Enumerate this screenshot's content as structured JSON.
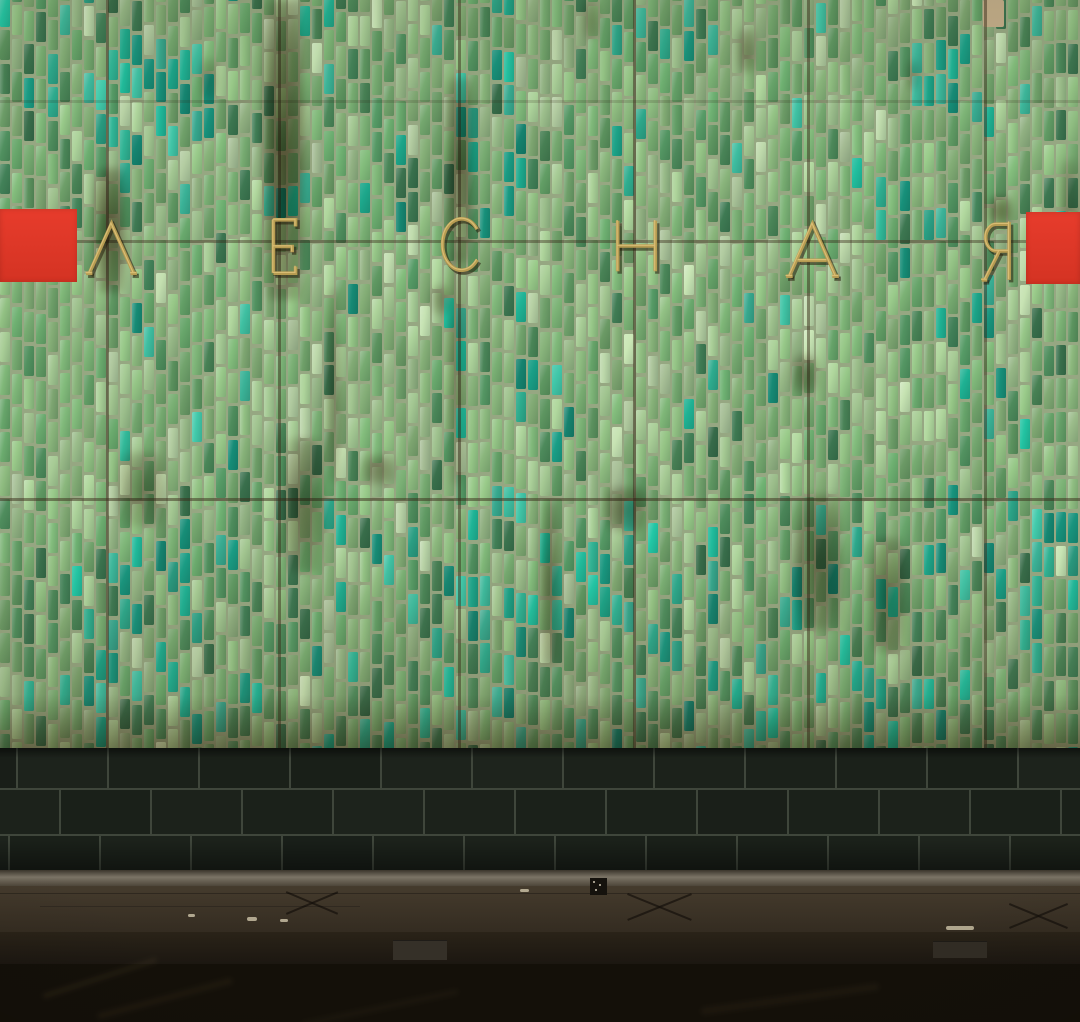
{
  "station_sign": {
    "text": "ЛЕСНАЯ",
    "letter_color": "#b79c52",
    "letter_highlight": "#d9bd74",
    "letter_shadow": "rgba(38,30,11,0.55)",
    "letters": [
      {
        "ch": "Л",
        "x": 85,
        "y": 221,
        "w": 53,
        "h": 55
      },
      {
        "ch": "Е",
        "x": 270,
        "y": 217,
        "w": 29,
        "h": 59
      },
      {
        "ch": "С",
        "x": 436,
        "y": 215,
        "w": 44,
        "h": 59
      },
      {
        "ch": "Н",
        "x": 613,
        "y": 218,
        "w": 47,
        "h": 56
      },
      {
        "ch": "А",
        "x": 785,
        "y": 221,
        "w": 55,
        "h": 58
      },
      {
        "ch": "Я",
        "x": 980,
        "y": 219,
        "w": 34,
        "h": 64
      }
    ]
  },
  "red_markers": {
    "color": "#e73c2c",
    "color_deep": "#d43323",
    "left": {
      "x": 0,
      "y": 209,
      "w": 77,
      "h": 73
    },
    "right": {
      "x": 1026,
      "y": 212,
      "w": 54,
      "h": 72
    }
  },
  "tile_wall": {
    "height": 748,
    "grout_color": "#96a782",
    "seed": 20240521,
    "tile": {
      "col_width": 12,
      "tile_width": 9.5,
      "row_height": 33.5,
      "tile_height": 30
    },
    "palette": {
      "pale_light": "#b5cfa3",
      "pale_sage": "#9fc28e",
      "sage": "#8ab67c",
      "mid": "#76aa70",
      "mid2": "#64a067",
      "deep": "#4e8c5c",
      "dark": "#3d7751",
      "teal_family": [
        "#2da98c",
        "#1fb496",
        "#17907a",
        "#3cb79b"
      ]
    },
    "band_weights": {
      "top": [
        [
          "pale_light",
          0.04
        ],
        [
          "pale_sage",
          0.14
        ],
        [
          "sage",
          0.24
        ],
        [
          "mid",
          0.24
        ],
        [
          "mid2",
          0.12
        ],
        [
          "deep",
          0.1
        ],
        [
          "dark",
          0.05
        ],
        [
          "teal",
          0.07
        ]
      ],
      "middle": [
        [
          "pale_light",
          0.05
        ],
        [
          "pale_sage",
          0.22
        ],
        [
          "sage",
          0.28
        ],
        [
          "mid",
          0.22
        ],
        [
          "mid2",
          0.1
        ],
        [
          "deep",
          0.06
        ],
        [
          "dark",
          0.03
        ],
        [
          "teal",
          0.04
        ]
      ],
      "bottom": [
        [
          "pale_light",
          0.02
        ],
        [
          "pale_sage",
          0.1
        ],
        [
          "sage",
          0.18
        ],
        [
          "mid",
          0.22
        ],
        [
          "mid2",
          0.14
        ],
        [
          "deep",
          0.14
        ],
        [
          "dark",
          0.07
        ],
        [
          "teal",
          0.13
        ]
      ]
    },
    "band_y": [
      234,
      496
    ],
    "teal_zones": [
      {
        "cx": 150,
        "cy": 110,
        "rx": 70,
        "ry": 80,
        "boost": 0.5
      },
      {
        "cx": 60,
        "cy": 65,
        "rx": 40,
        "ry": 55,
        "boost": 0.45
      },
      {
        "cx": 500,
        "cy": 110,
        "rx": 60,
        "ry": 90,
        "boost": 0.35
      },
      {
        "cx": 660,
        "cy": 30,
        "rx": 55,
        "ry": 40,
        "boost": 0.4
      },
      {
        "cx": 945,
        "cy": 85,
        "rx": 50,
        "ry": 45,
        "boost": 0.45
      },
      {
        "cx": 860,
        "cy": 170,
        "rx": 40,
        "ry": 40,
        "boost": 0.3
      },
      {
        "cx": 1040,
        "cy": 130,
        "rx": 50,
        "ry": 60,
        "boost": 0.3
      },
      {
        "cx": 213,
        "cy": 400,
        "rx": 40,
        "ry": 45,
        "boost": 0.35
      },
      {
        "cx": 450,
        "cy": 330,
        "rx": 45,
        "ry": 60,
        "boost": 0.35
      },
      {
        "cx": 530,
        "cy": 430,
        "rx": 50,
        "ry": 60,
        "boost": 0.3
      },
      {
        "cx": 970,
        "cy": 350,
        "rx": 40,
        "ry": 50,
        "boost": 0.35
      },
      {
        "cx": 770,
        "cy": 300,
        "rx": 30,
        "ry": 40,
        "boost": 0.3
      },
      {
        "cx": 160,
        "cy": 610,
        "rx": 110,
        "ry": 80,
        "boost": 0.45
      },
      {
        "cx": 490,
        "cy": 630,
        "rx": 70,
        "ry": 80,
        "boost": 0.5
      },
      {
        "cx": 610,
        "cy": 590,
        "rx": 50,
        "ry": 60,
        "boost": 0.4
      },
      {
        "cx": 560,
        "cy": 530,
        "rx": 30,
        "ry": 40,
        "boost": 0.4
      },
      {
        "cx": 1050,
        "cy": 590,
        "rx": 50,
        "ry": 80,
        "boost": 0.5
      }
    ],
    "stain_color": "96,70,38",
    "stains": [
      {
        "x": 263,
        "y": 0,
        "w": 42,
        "h": 300,
        "a": 0.72
      },
      {
        "x": 94,
        "y": 168,
        "w": 32,
        "h": 125,
        "a": 0.7
      },
      {
        "x": 446,
        "y": 78,
        "w": 28,
        "h": 185,
        "a": 0.6
      },
      {
        "x": 448,
        "y": 250,
        "w": 16,
        "h": 235,
        "a": 0.38
      },
      {
        "x": 327,
        "y": 288,
        "w": 13,
        "h": 195,
        "a": 0.42
      },
      {
        "x": 283,
        "y": 438,
        "w": 42,
        "h": 135,
        "a": 0.5
      },
      {
        "x": 118,
        "y": 452,
        "w": 48,
        "h": 75,
        "a": 0.4
      },
      {
        "x": 363,
        "y": 455,
        "w": 32,
        "h": 30,
        "a": 0.45
      },
      {
        "x": 605,
        "y": 487,
        "w": 42,
        "h": 45,
        "a": 0.5
      },
      {
        "x": 795,
        "y": 495,
        "w": 48,
        "h": 135,
        "a": 0.55
      },
      {
        "x": 868,
        "y": 538,
        "w": 38,
        "h": 115,
        "a": 0.5
      },
      {
        "x": 540,
        "y": 500,
        "w": 20,
        "h": 165,
        "a": 0.5
      },
      {
        "x": 988,
        "y": 196,
        "w": 24,
        "h": 30,
        "a": 0.6
      },
      {
        "x": 738,
        "y": 28,
        "w": 18,
        "h": 45,
        "a": 0.45
      },
      {
        "x": 200,
        "y": 58,
        "w": 18,
        "h": 42,
        "a": 0.3
      },
      {
        "x": 792,
        "y": 355,
        "w": 26,
        "h": 38,
        "a": 0.45
      },
      {
        "x": 1060,
        "y": 160,
        "w": 20,
        "h": 120,
        "a": 0.35
      },
      {
        "x": 432,
        "y": 285,
        "w": 18,
        "h": 30,
        "a": 0.4
      },
      {
        "x": 906,
        "y": 60,
        "w": 14,
        "h": 30,
        "a": 0.3
      },
      {
        "x": 583,
        "y": 0,
        "w": 16,
        "h": 40,
        "a": 0.35
      }
    ],
    "rust_band": {
      "y": 695,
      "h": 53,
      "alpha": 0.45
    },
    "missing_tile": {
      "x": 983,
      "y": 0,
      "w": 21,
      "h": 27,
      "color": "#c4ad8a"
    },
    "seams": {
      "color": "58,44,26",
      "vertical_x": [
        106,
        278,
        458,
        633,
        807,
        984
      ],
      "horizontal": [
        {
          "y": 100,
          "alpha": 0.18
        },
        {
          "y": 240,
          "alpha": 0.42
        },
        {
          "y": 498,
          "alpha": 0.5
        }
      ]
    }
  },
  "plinth": {
    "y": 748,
    "height": 126,
    "brick_color": "#1b211a",
    "mortar_color": "#3f463b",
    "brick_width": 91,
    "gap": 2,
    "rows": [
      {
        "y": 748,
        "h": 42,
        "offset": 18
      },
      {
        "y": 790,
        "h": 46,
        "offset": -30
      },
      {
        "y": 836,
        "h": 38,
        "offset": 10
      }
    ]
  },
  "platform": {
    "edge_highlight": {
      "y": 870,
      "h": 16,
      "color_top": "#3a352b",
      "color_mid": "#7b7466",
      "color_bottom": "#4e463a"
    },
    "surface": {
      "y": 886,
      "h": 46,
      "color": "#453b2d",
      "color_dark": "#342c21"
    },
    "front": {
      "y": 932,
      "h": 32,
      "color": "#2a2318",
      "color_dark": "#1c1711"
    },
    "boxes": [
      {
        "x": 393,
        "y": 940,
        "w": 54,
        "h": 20,
        "color": "#353028"
      },
      {
        "x": 933,
        "y": 941,
        "w": 54,
        "h": 17,
        "color": "#322d25"
      }
    ],
    "x_marks": [
      {
        "cx": 312,
        "cy": 902,
        "w": 52,
        "h": 22
      },
      {
        "cx": 660,
        "cy": 906,
        "w": 64,
        "h": 26
      },
      {
        "cx": 1038,
        "cy": 915,
        "w": 58,
        "h": 24
      }
    ],
    "mark_color": "rgba(18,14,9,0.65)",
    "scratches": [
      {
        "x": 0,
        "y": 893,
        "w": 1080,
        "h": 1,
        "a": 0.28
      },
      {
        "x": 40,
        "y": 906,
        "w": 320,
        "h": 1,
        "a": 0.2
      }
    ],
    "chips": [
      {
        "x": 247,
        "y": 917,
        "w": 10,
        "h": 4
      },
      {
        "x": 188,
        "y": 914,
        "w": 7,
        "h": 3
      },
      {
        "x": 280,
        "y": 919,
        "w": 8,
        "h": 3
      },
      {
        "x": 946,
        "y": 926,
        "w": 28,
        "h": 4
      },
      {
        "x": 520,
        "y": 889,
        "w": 9,
        "h": 3
      }
    ],
    "chip_color": "#cfc5aa",
    "sticker": {
      "x": 590,
      "y": 878,
      "w": 17,
      "h": 17,
      "color": "#15120d"
    }
  },
  "track": {
    "y": 964,
    "h": 58,
    "color": "#141009",
    "streak_color": "140,115,70",
    "streaks": [
      {
        "x": 40,
        "y": 975,
        "w": 120,
        "h": 6,
        "rot": -18,
        "a": 0.1
      },
      {
        "x": 95,
        "y": 995,
        "w": 140,
        "h": 7,
        "rot": -15,
        "a": 0.08
      },
      {
        "x": 700,
        "y": 995,
        "w": 180,
        "h": 8,
        "rot": -8,
        "a": 0.07
      },
      {
        "x": 300,
        "y": 1005,
        "w": 160,
        "h": 6,
        "rot": -12,
        "a": 0.06
      }
    ]
  }
}
